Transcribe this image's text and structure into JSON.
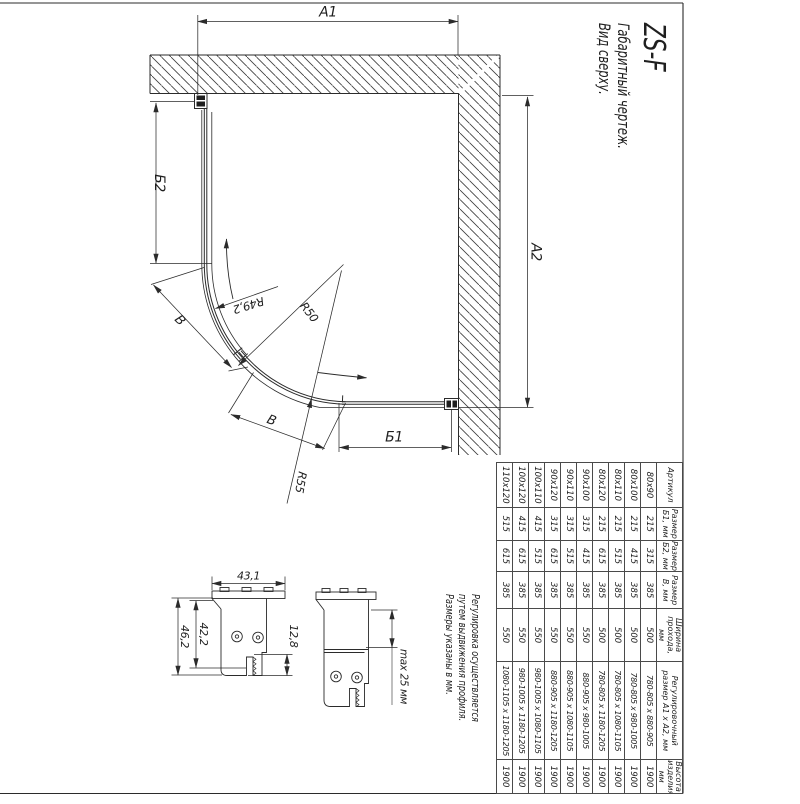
{
  "sheet": {
    "title": {
      "model": "ZS-F",
      "subtitle1": "Габаритный чертеж.",
      "subtitle2": "Вид сверху."
    },
    "notes": {
      "line1": "Регулировка осуществляется",
      "line2": "путем выдвижения профиля.",
      "line3": "Размеры указаны в мм."
    }
  },
  "plan": {
    "dims": {
      "a1": "A1",
      "a2": "A2",
      "b1": "Б1",
      "b2": "Б2",
      "door_left": "В",
      "door_right": "В",
      "r_inner": "R49,2",
      "r_door": "R50",
      "r_outer": "R55"
    }
  },
  "profiles": {
    "dims": {
      "flange_width": "43,1",
      "outer_height": "46,2",
      "inner_height": "42,2",
      "step": "12,8",
      "adjustment": "max 25 мм"
    }
  },
  "table": {
    "headers": [
      "Артикул",
      "Размер Б1, мм",
      "Размер Б2, мм",
      "Размер В, мм",
      "Ширина прохода, мм",
      "Регулировочный размер А1 х А2, мм",
      "Высота изделия, мм"
    ],
    "rows": [
      [
        "80х90",
        "215",
        "315",
        "385",
        "500",
        "780-805 х 880-905",
        "1900"
      ],
      [
        "80х100",
        "215",
        "415",
        "385",
        "500",
        "780-805 х 980-1005",
        "1900"
      ],
      [
        "80х110",
        "215",
        "515",
        "385",
        "500",
        "780-805 х 1080-1105",
        "1900"
      ],
      [
        "80х120",
        "215",
        "615",
        "385",
        "500",
        "780-805 х 1180-1205",
        "1900"
      ],
      [
        "90х100",
        "315",
        "415",
        "385",
        "550",
        "880-905 х 980-1005",
        "1900"
      ],
      [
        "90х110",
        "315",
        "515",
        "385",
        "550",
        "880-905 х 1080-1105",
        "1900"
      ],
      [
        "90х120",
        "315",
        "615",
        "385",
        "550",
        "880-905 х 1180-1205",
        "1900"
      ],
      [
        "100х110",
        "415",
        "515",
        "385",
        "550",
        "980-1005 х 1080-1105",
        "1900"
      ],
      [
        "100х120",
        "415",
        "615",
        "385",
        "550",
        "980-1005 х 1180-1205",
        "1900"
      ],
      [
        "110х120",
        "515",
        "615",
        "385",
        "550",
        "1080-1105 х 1180-1205",
        "1900"
      ]
    ]
  },
  "colors": {
    "line": "#2b2b2b",
    "text": "#1f1f1f",
    "background": "#ffffff"
  }
}
